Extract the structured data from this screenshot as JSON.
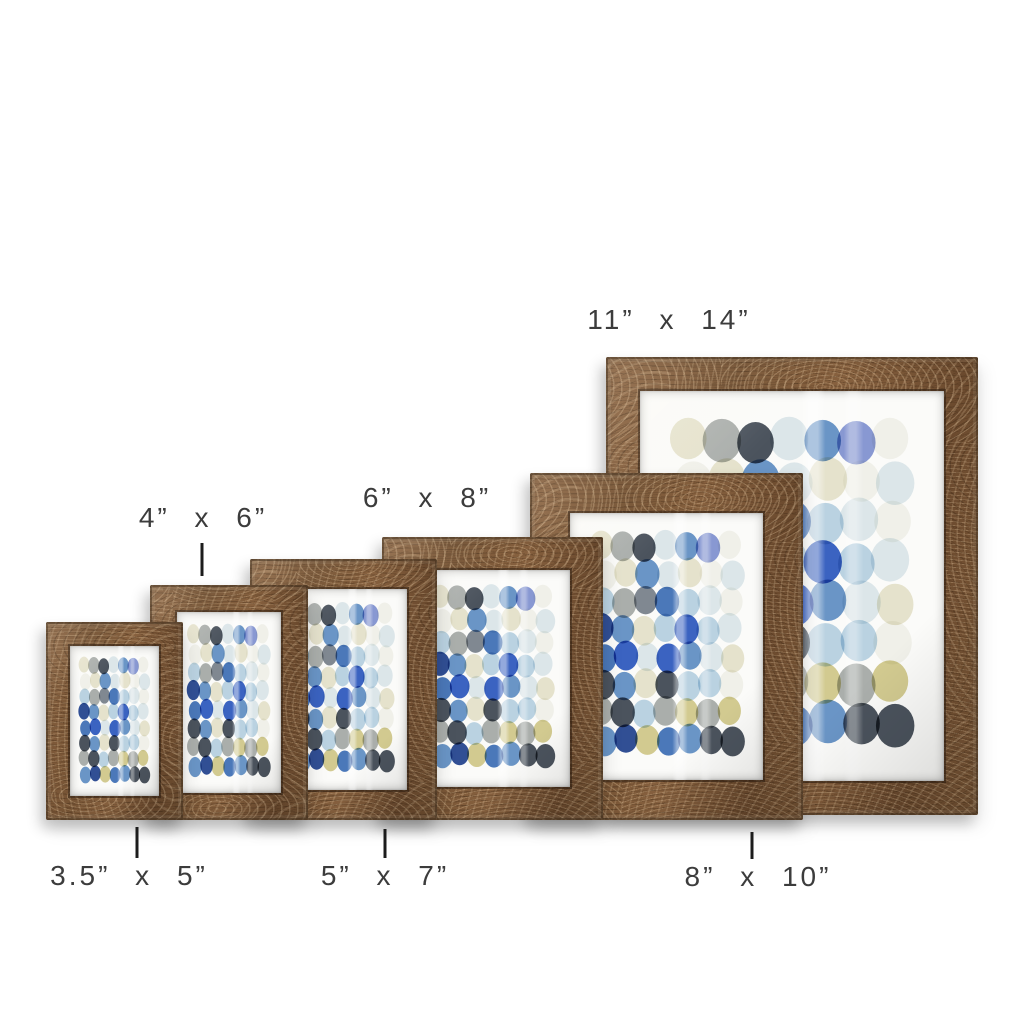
{
  "scene": {
    "width": 1024,
    "height": 1024,
    "background": "#ffffff"
  },
  "typography": {
    "label_color": "#3c3c3c",
    "tick_color": "#1c1c1c"
  },
  "wood": {
    "base": "#7a583a",
    "light": "#a67c4f",
    "dark": "#583d26"
  },
  "paper": {
    "color": "#fbfbf9"
  },
  "artwork": {
    "description_colors": [
      "navy",
      "royal-blue",
      "light-blue",
      "pale-blue",
      "cream",
      "olive",
      "gray",
      "charcoal",
      "white"
    ],
    "palette": {
      "cream": "#e7e4cd",
      "olive": "#d3ca8b",
      "white": "#f3f3ee",
      "paleblue": "#dde8ee",
      "lightblue": "#b7d2e5",
      "blue": "#5f8ec7",
      "mblue": "#3d6fb9",
      "royal": "#2b57c1",
      "navy": "#20418f",
      "periwinkle": "#8093d4",
      "gray": "#a6aaa8",
      "slate": "#77808c",
      "charcoal": "#3d4551"
    },
    "cols": 7,
    "rows": 8,
    "grid": [
      [
        "cream",
        "gray",
        "charcoal",
        "paleblue",
        "blue",
        "periwinkle",
        "white"
      ],
      [
        "white",
        "cream",
        "blue",
        "paleblue",
        "cream",
        "white",
        "paleblue"
      ],
      [
        "lightblue",
        "gray",
        "slate",
        "mblue",
        "lightblue",
        "paleblue",
        "white"
      ],
      [
        "navy",
        "blue",
        "cream",
        "lightblue",
        "royal",
        "lightblue",
        "paleblue"
      ],
      [
        "mblue",
        "royal",
        "paleblue",
        "royal",
        "blue",
        "paleblue",
        "cream"
      ],
      [
        "charcoal",
        "blue",
        "cream",
        "charcoal",
        "lightblue",
        "lightblue",
        "white"
      ],
      [
        "gray",
        "charcoal",
        "lightblue",
        "gray",
        "olive",
        "gray",
        "olive"
      ],
      [
        "blue",
        "navy",
        "olive",
        "mblue",
        "blue",
        "charcoal",
        "charcoal"
      ]
    ]
  },
  "frames": [
    {
      "id": "3-5x5",
      "size": "3.5\" x 5\"",
      "x": 46,
      "y": 622,
      "w": 137,
      "h": 198,
      "border": 24,
      "z": 60
    },
    {
      "id": "4x6",
      "size": "4\" x 6\"",
      "x": 150,
      "y": 585,
      "w": 158,
      "h": 235,
      "border": 27,
      "z": 50
    },
    {
      "id": "5x7",
      "size": "5\" x 7\"",
      "x": 250,
      "y": 559,
      "w": 187,
      "h": 261,
      "border": 30,
      "z": 40
    },
    {
      "id": "6x8",
      "size": "6\" x 8\"",
      "x": 382,
      "y": 537,
      "w": 221,
      "h": 283,
      "border": 33,
      "z": 30
    },
    {
      "id": "8x10",
      "size": "8\" x 10\"",
      "x": 530,
      "y": 473,
      "w": 273,
      "h": 347,
      "border": 40,
      "z": 20
    },
    {
      "id": "11x14",
      "size": "11\" x 14\"",
      "x": 606,
      "y": 357,
      "w": 372,
      "h": 458,
      "border": 34,
      "z": 10
    }
  ],
  "labels": [
    {
      "id": "3-5x5",
      "text": "3.5” x 5”",
      "cx": 129,
      "top": 860
    },
    {
      "id": "5x7",
      "text": "5” x 7”",
      "cx": 385,
      "top": 860
    },
    {
      "id": "8x10",
      "text": "8” x 10”",
      "cx": 758,
      "top": 861
    },
    {
      "id": "4x6",
      "text": "4” x 6”",
      "cx": 203,
      "top": 502
    },
    {
      "id": "6x8",
      "text": "6” x 8”",
      "cx": 427,
      "top": 482
    },
    {
      "id": "11x14",
      "text": "11” x 14”",
      "cx": 669,
      "top": 304
    }
  ],
  "ticks": [
    {
      "id": "tick-4x6",
      "x": 202,
      "y": 543,
      "h": 33
    },
    {
      "id": "tick-3-5x5",
      "x": 137,
      "y": 827,
      "h": 31
    },
    {
      "id": "tick-5x7",
      "x": 385,
      "y": 829,
      "h": 29
    },
    {
      "id": "tick-8x10",
      "x": 752,
      "y": 832,
      "h": 27
    }
  ]
}
